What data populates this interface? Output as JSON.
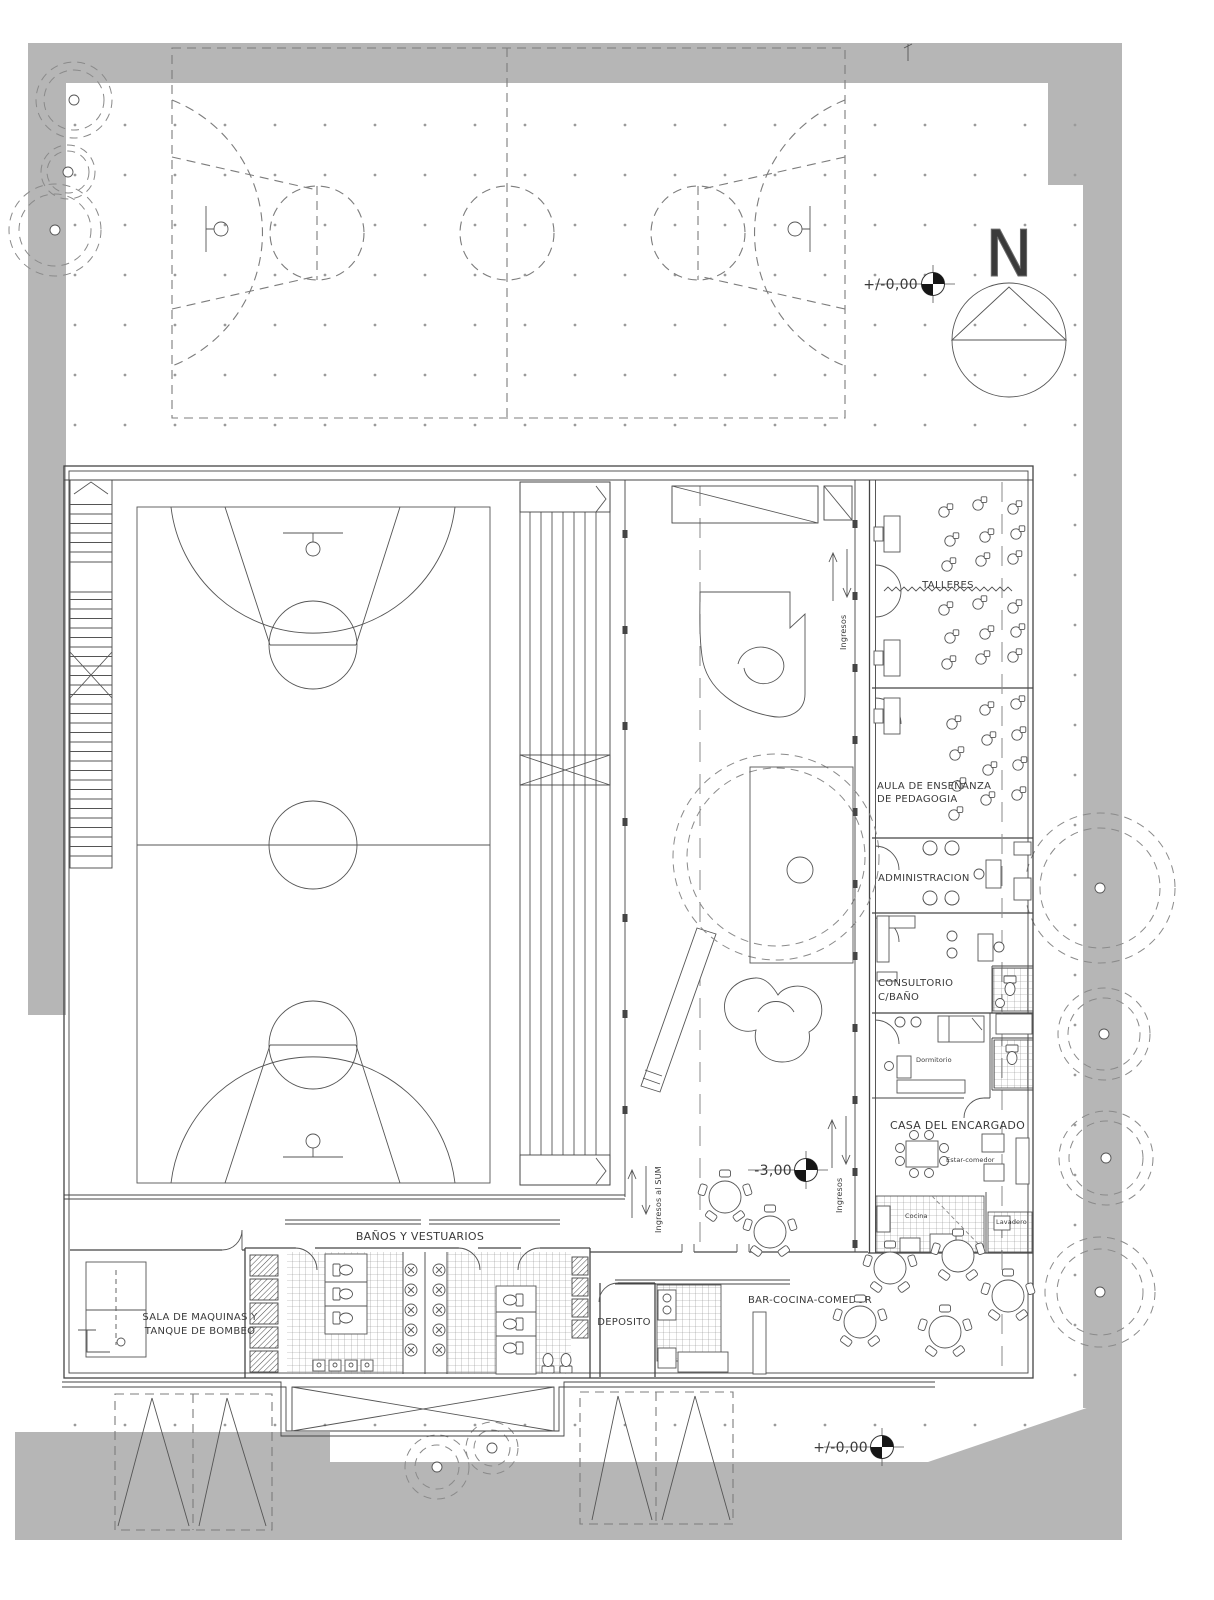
{
  "labels": {
    "talleres": "TALLERES",
    "aula_line1": "AULA DE ENSEÑANZA",
    "aula_line2": "DE PEDAGOGIA",
    "administracion": "ADMINISTRACION",
    "consultorio_line1": "CONSULTORIO",
    "consultorio_line2": "C/BAÑO",
    "casa_encargado": "CASA DEL ENCARGADO",
    "dormitorio": "Dormitorio",
    "estar_comedor": "Estar-comedor",
    "cocina": "Cocina",
    "lavadero": "Lavadero",
    "banos_vestuarios": "BAÑOS Y VESTUARIOS",
    "sala_maquinas_line1": "SALA DE MAQUINAS Y",
    "sala_maquinas_line2": "TANQUE DE BOMBEO",
    "deposito": "DEPOSITO",
    "bar_cocina_comedor": "BAR-COCINA-COMEDOR",
    "ingresos_al_sum": "Ingresos al SUM",
    "ingresos_top": "Ingresos",
    "ingresos_bottom": "Ingresos",
    "north": "N"
  },
  "levels": {
    "ground_top": "+/-0,00",
    "sum": "-3,00",
    "ground_bottom": "+/-0,00"
  },
  "colors": {
    "site_grey": "#b6b6b6",
    "wall_line": "#454545",
    "dashed_line": "#7c7c7c",
    "text": "#3a3a3a"
  }
}
